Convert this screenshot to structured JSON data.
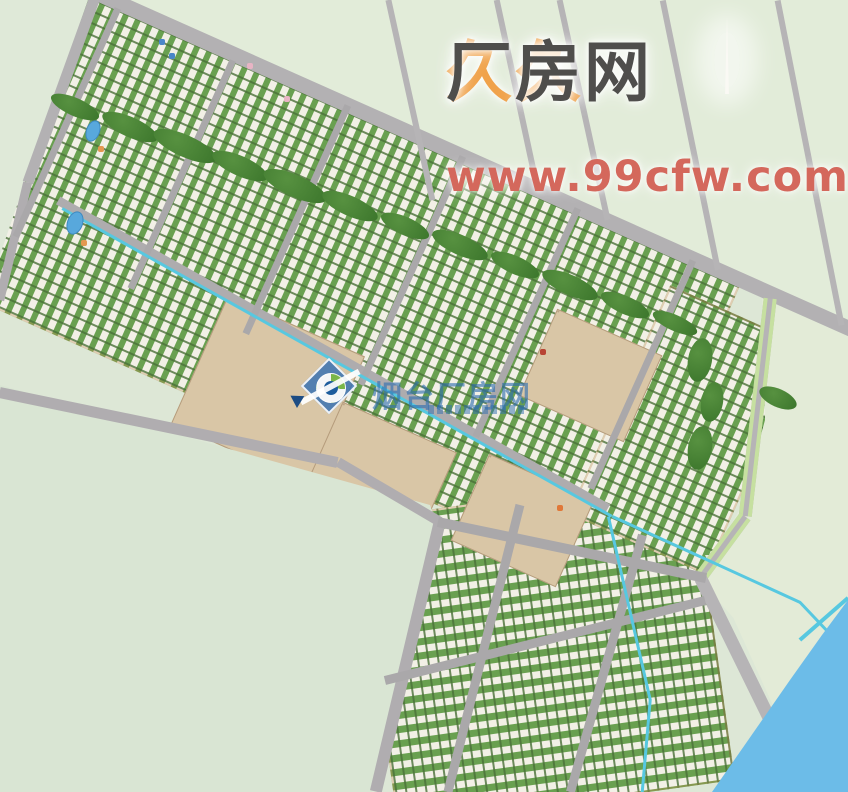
{
  "watermarks": {
    "top": {
      "brand_prefix": "久久",
      "brand_suffix": "厂房网",
      "url": "www.99cfw.com",
      "prefix_color": "#f0a24a",
      "suffix_color": "#4f4e4c",
      "url_color": "#d4685c"
    },
    "center": {
      "text": "烟台厂房网",
      "color": "#2e6eb0",
      "logo": "compass-diamond-logo"
    }
  },
  "scene": {
    "bg_color": "#dde7d6",
    "water_color": "#6cbce8",
    "canal_color": "#57c8e0",
    "road_color": "#b3b1b3",
    "fields_under": [
      {
        "n": "field-northeast",
        "pts": "95 0,848 0,848 332",
        "c": "#e2ecd9"
      }
    ],
    "groups": [
      {
        "n": "industrial-band-upper",
        "cx": 310,
        "cy": 268,
        "w": 800,
        "h": 330,
        "rot": 24,
        "pat": "cross"
      },
      {
        "n": "industrial-district-lower",
        "cx": 545,
        "cy": 650,
        "w": 340,
        "h": 310,
        "rot": -8,
        "pat": "flat"
      },
      {
        "n": "industrial-district-right",
        "cx": 688,
        "cy": 430,
        "w": 150,
        "h": 250,
        "rot": 24,
        "pat": "cross"
      }
    ],
    "beige_clusters": [
      {
        "cx": 268,
        "cy": 390,
        "w": 150,
        "h": 140,
        "rot": 24
      },
      {
        "cx": 380,
        "cy": 470,
        "w": 125,
        "h": 95,
        "rot": 24
      },
      {
        "cx": 590,
        "cy": 375,
        "w": 115,
        "h": 95,
        "rot": 24
      },
      {
        "cx": 522,
        "cy": 520,
        "w": 115,
        "h": 95,
        "rot": 24
      }
    ],
    "masks_over": [
      {
        "n": "field-west",
        "pts": "0 385,430 505,442 540,372 792,0 792",
        "c": "#d9e5d3"
      },
      {
        "n": "field-north-corner",
        "pts": "0 0,88 0,24 185,0 255",
        "c": "#dfe9d8"
      },
      {
        "n": "field-east",
        "pts": "762 298,848 336,848 600,815 640,790 682,700 580,742 505,765 420",
        "c": "#e3ebd7"
      },
      {
        "n": "field-southeast",
        "pts": "705 555,812 792,870 792,870 555",
        "c": "#e3ebd7"
      }
    ],
    "roads": [
      {
        "n": "road-arterial-main",
        "x1": 95,
        "y1": -8,
        "x2": 858,
        "y2": 332,
        "w": 15,
        "c": "#b3b1b3"
      },
      {
        "n": "road-topleft-steep",
        "x1": 96,
        "y1": -6,
        "x2": 28,
        "y2": 182,
        "w": 11,
        "c": "#b3b1b3"
      },
      {
        "n": "road-left-edge",
        "x1": 28,
        "y1": 182,
        "x2": 0,
        "y2": 300,
        "w": 9,
        "c": "#b0adb0"
      },
      {
        "n": "road-band-bottom",
        "x1": 0,
        "y1": 392,
        "x2": 338,
        "y2": 462,
        "w": 11,
        "c": "#b0adb0"
      },
      {
        "n": "road-band-bottom-2",
        "x1": 338,
        "y1": 462,
        "x2": 440,
        "y2": 522,
        "w": 10,
        "c": "#b0adb0"
      },
      {
        "n": "road-lower-left-boundary",
        "x1": 440,
        "y1": 522,
        "x2": 376,
        "y2": 792,
        "w": 12,
        "c": "#b0adb0"
      },
      {
        "n": "road-mid-band",
        "x1": 58,
        "y1": 200,
        "x2": 608,
        "y2": 508,
        "w": 9,
        "c": "#aeacae"
      },
      {
        "n": "road-cross-0",
        "x1": 118,
        "y1": 8,
        "x2": 16,
        "y2": 236,
        "w": 7,
        "c": "#aaa8aa"
      },
      {
        "n": "road-cross-1",
        "x1": 233,
        "y1": 60,
        "x2": 131,
        "y2": 288,
        "w": 7,
        "c": "#aaa8aa"
      },
      {
        "n": "road-cross-2",
        "x1": 348,
        "y1": 105,
        "x2": 246,
        "y2": 333,
        "w": 7,
        "c": "#aaa8aa"
      },
      {
        "n": "road-cross-3",
        "x1": 463,
        "y1": 156,
        "x2": 361,
        "y2": 384,
        "w": 7,
        "c": "#aaa8aa"
      },
      {
        "n": "road-cross-4",
        "x1": 578,
        "y1": 208,
        "x2": 476,
        "y2": 436,
        "w": 7,
        "c": "#aaa8aa"
      },
      {
        "n": "road-cross-5",
        "x1": 693,
        "y1": 260,
        "x2": 591,
        "y2": 488,
        "w": 7,
        "c": "#aaa8aa"
      },
      {
        "n": "road-north-1",
        "x1": 388,
        "y1": 0,
        "x2": 432,
        "y2": 200,
        "w": 6,
        "c": "#b6b4b6"
      },
      {
        "n": "road-north-2",
        "x1": 497,
        "y1": 0,
        "x2": 538,
        "y2": 190,
        "w": 6,
        "c": "#b6b4b6"
      },
      {
        "n": "road-north-3",
        "x1": 560,
        "y1": 0,
        "x2": 608,
        "y2": 220,
        "w": 6,
        "c": "#b6b4b6"
      },
      {
        "n": "road-north-4",
        "x1": 663,
        "y1": 0,
        "x2": 718,
        "y2": 269,
        "w": 6,
        "c": "#b6b4b6"
      },
      {
        "n": "road-north-5",
        "x1": 778,
        "y1": 0,
        "x2": 842,
        "y2": 325,
        "w": 6,
        "c": "#b6b4b6"
      },
      {
        "n": "road-east-1",
        "x1": 770,
        "y1": 302,
        "x2": 745,
        "y2": 520,
        "w": 13,
        "c": "#b6b4b6",
        "m": 1
      },
      {
        "n": "road-east-2",
        "x1": 745,
        "y1": 520,
        "x2": 701,
        "y2": 580,
        "w": 13,
        "c": "#b6b4b6",
        "m": 1
      },
      {
        "n": "road-riverside",
        "x1": 701,
        "y1": 578,
        "x2": 806,
        "y2": 792,
        "w": 13,
        "c": "#b6b4b6"
      },
      {
        "n": "road-lower-v1",
        "x1": 520,
        "y1": 505,
        "x2": 448,
        "y2": 792,
        "w": 9,
        "c": "#aaa8aa"
      },
      {
        "n": "road-lower-v2",
        "x1": 642,
        "y1": 535,
        "x2": 570,
        "y2": 792,
        "w": 9,
        "c": "#aaa8aa"
      },
      {
        "n": "road-lower-top",
        "x1": 438,
        "y1": 522,
        "x2": 706,
        "y2": 578,
        "w": 10,
        "c": "#aaa8aa"
      },
      {
        "n": "road-lower-cross",
        "x1": 385,
        "y1": 680,
        "x2": 705,
        "y2": 600,
        "w": 9,
        "c": "#aaa8aa"
      }
    ],
    "canals": [
      {
        "x1": 62,
        "y1": 208,
        "x2": 612,
        "y2": 516,
        "w": 3
      },
      {
        "x1": 612,
        "y1": 516,
        "x2": 800,
        "y2": 602,
        "w": 3
      },
      {
        "x1": 800,
        "y1": 602,
        "x2": 836,
        "y2": 640,
        "w": 3
      },
      {
        "x1": 608,
        "y1": 516,
        "x2": 650,
        "y2": 700,
        "w": 3
      },
      {
        "x1": 650,
        "y1": 700,
        "x2": 642,
        "y2": 792,
        "w": 3
      },
      {
        "x1": 800,
        "y1": 640,
        "x2": 848,
        "y2": 598,
        "w": 4
      }
    ],
    "trees": [
      [
        75,
        107,
        26,
        9,
        24
      ],
      [
        130,
        127,
        30,
        10,
        24
      ],
      [
        185,
        146,
        34,
        11,
        24
      ],
      [
        240,
        166,
        30,
        10,
        24
      ],
      [
        295,
        186,
        34,
        11,
        24
      ],
      [
        350,
        206,
        30,
        10,
        24
      ],
      [
        405,
        226,
        26,
        9,
        24
      ],
      [
        460,
        245,
        30,
        10,
        24
      ],
      [
        515,
        265,
        26,
        9,
        24
      ],
      [
        570,
        285,
        30,
        10,
        24
      ],
      [
        625,
        305,
        26,
        9,
        24
      ],
      [
        675,
        323,
        24,
        8,
        24
      ],
      [
        700,
        360,
        12,
        22,
        10
      ],
      [
        712,
        402,
        11,
        20,
        10
      ],
      [
        700,
        448,
        12,
        22,
        10
      ],
      [
        778,
        398,
        20,
        9,
        24
      ]
    ],
    "ponds": [
      {
        "cx": 93,
        "cy": 131,
        "rx": 7,
        "ry": 11,
        "rot": 20
      },
      {
        "cx": 75,
        "cy": 223,
        "rx": 8,
        "ry": 12,
        "rot": 20
      }
    ],
    "accents": [
      {
        "x": 101,
        "y": 149,
        "c": "#e49850"
      },
      {
        "x": 84,
        "y": 243,
        "c": "#e49850"
      },
      {
        "x": 560,
        "y": 508,
        "c": "#e07838"
      },
      {
        "x": 543,
        "y": 352,
        "c": "#b84434"
      },
      {
        "x": 250,
        "y": 66,
        "c": "#e8b4c4"
      },
      {
        "x": 287,
        "y": 99,
        "c": "#e8b4c4"
      },
      {
        "x": 162,
        "y": 42,
        "c": "#4a86c8"
      },
      {
        "x": 172,
        "y": 56,
        "c": "#4a86c8"
      }
    ],
    "river": {
      "pts": "848 600,848 792,712 792,790 680,822 635",
      "c": "#6cbce8"
    },
    "obelisk": {
      "cx": 727,
      "cy": 56
    }
  }
}
